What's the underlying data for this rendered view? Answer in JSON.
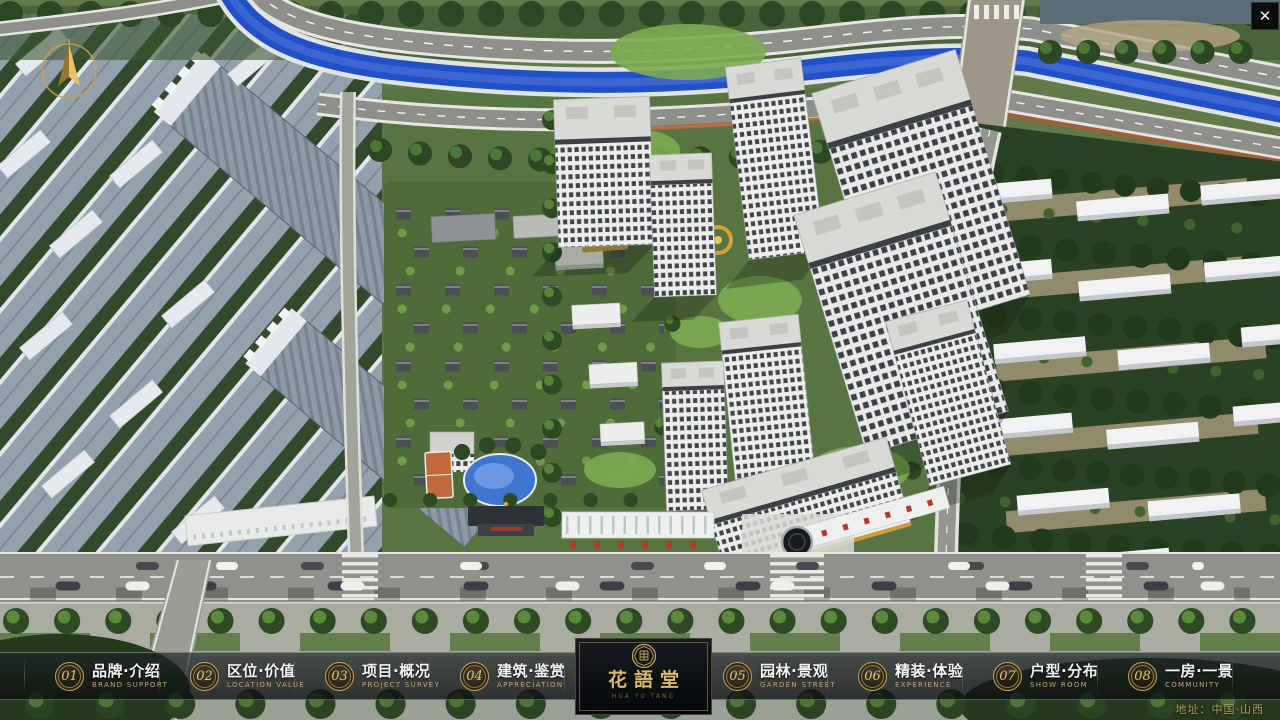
{
  "app": {
    "close_glyph": "✕"
  },
  "nav": {
    "items": [
      {
        "num": "01",
        "zh": "品牌·介绍",
        "en": "BRAND SUPPORT"
      },
      {
        "num": "02",
        "zh": "区位·价值",
        "en": "LOCATION VALUE"
      },
      {
        "num": "03",
        "zh": "项目·概况",
        "en": "PROJECT SURVEY"
      },
      {
        "num": "04",
        "zh": "建筑·鉴赏",
        "en": "APPRECIATION"
      },
      {
        "num": "05",
        "zh": "园林·景观",
        "en": "GARDEN STREET"
      },
      {
        "num": "06",
        "zh": "精装·体验",
        "en": "EXPERIENCE"
      },
      {
        "num": "07",
        "zh": "户型·分布",
        "en": "SHOW ROOM"
      },
      {
        "num": "08",
        "zh": "一房·一景",
        "en": "COMMUNITY"
      }
    ]
  },
  "logo": {
    "title": "花語堂",
    "tagline": "HUA YU TANG"
  },
  "footer": {
    "address": "地址：中国·山西"
  },
  "colors": {
    "gold": "#c9a961",
    "gold_bright": "#e3c173",
    "bar_background": "rgba(12,16,18,0.7)",
    "river_blue": "#2150c8",
    "foliage_dark": "#2c4723",
    "tower_white": "#edeeec"
  }
}
